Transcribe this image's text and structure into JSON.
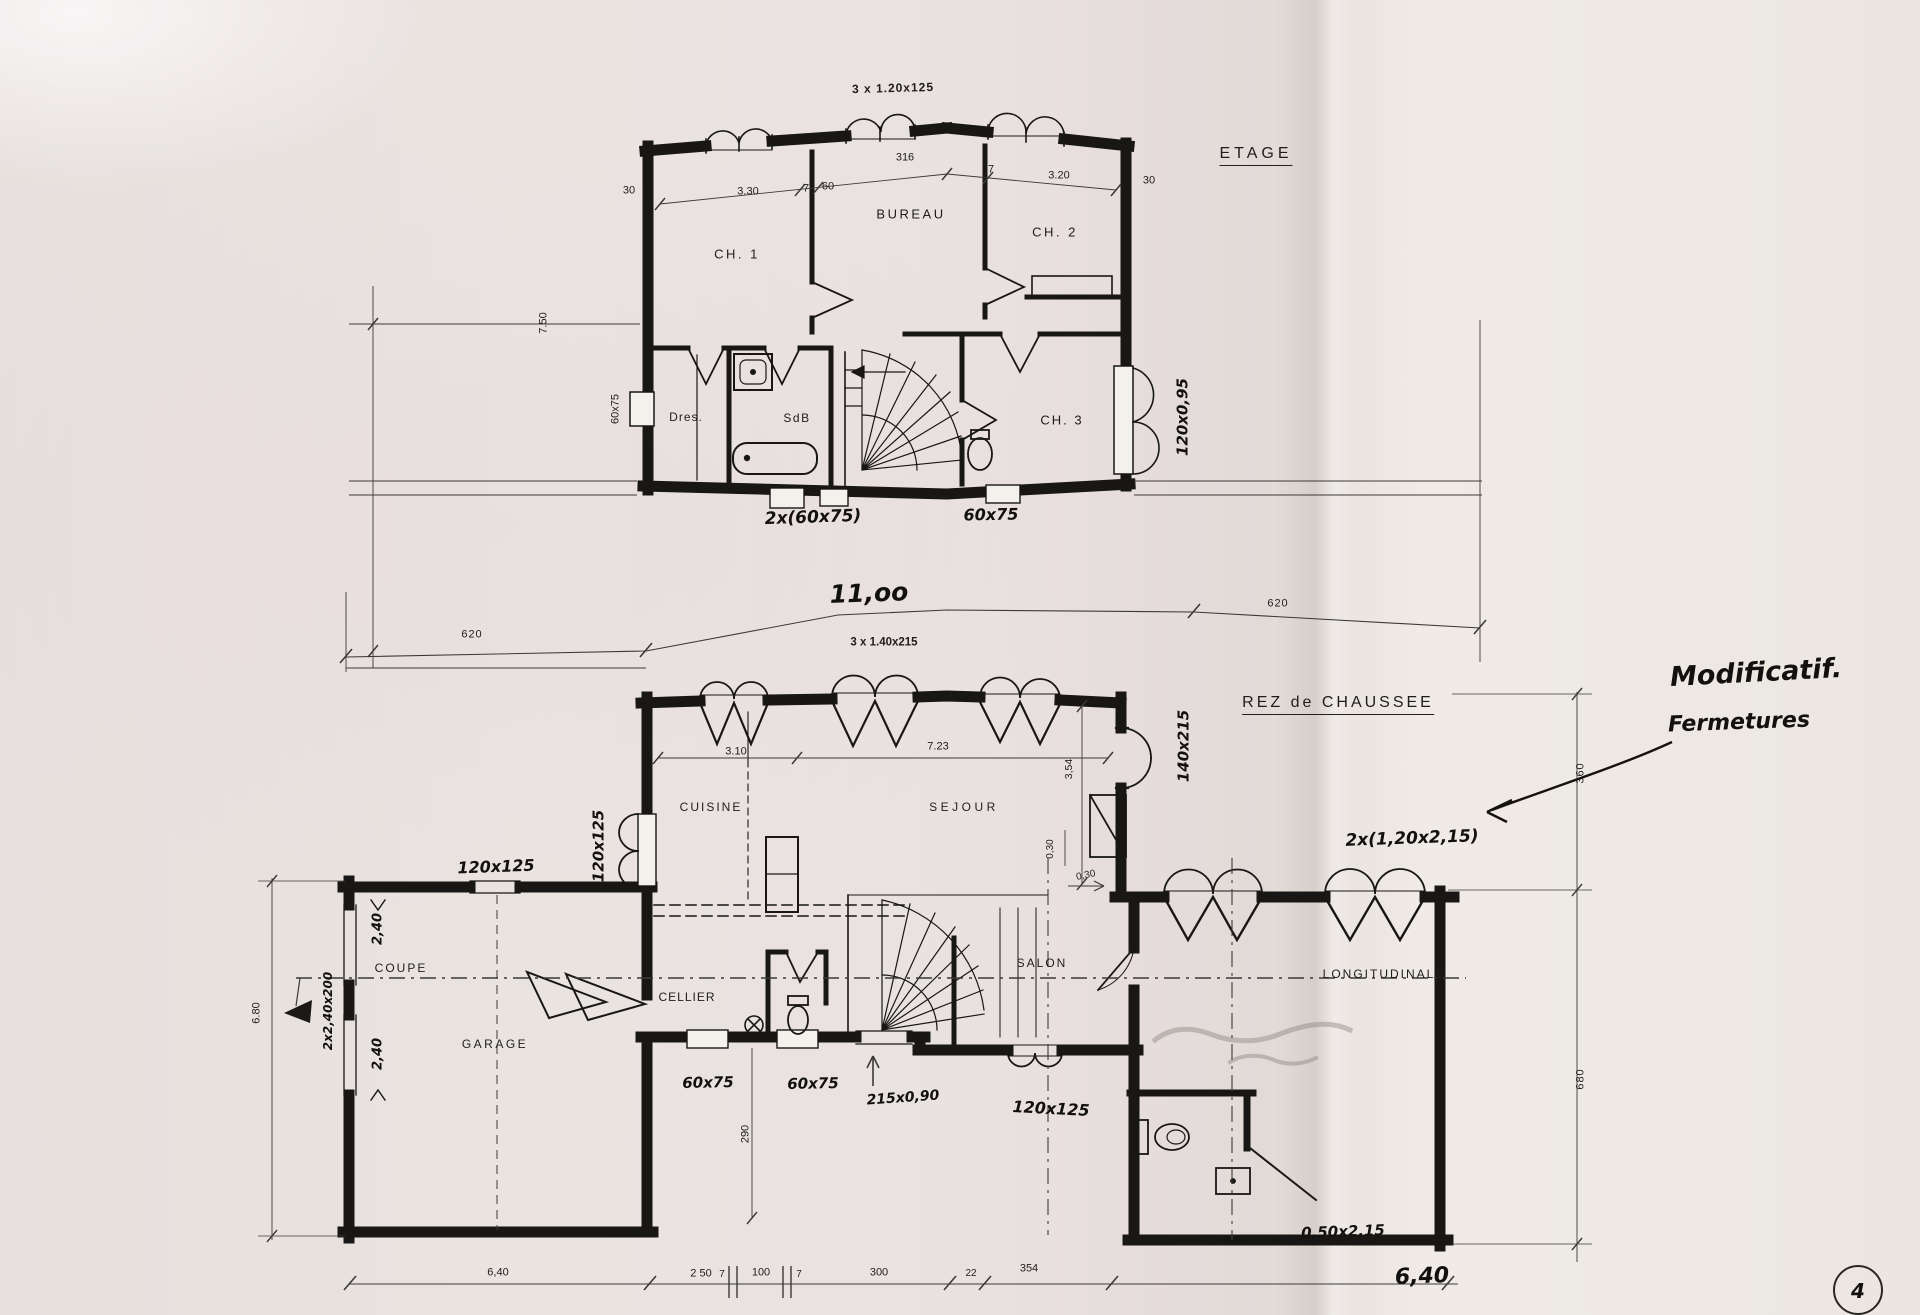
{
  "etage": {
    "title": "ETAGE",
    "window_note": "3 x 1.20x125",
    "rooms": {
      "ch1": "CH. 1",
      "bureau": "BUREAU",
      "ch2": "CH. 2",
      "dres": "Dres.",
      "sdb": "SdB",
      "ch3": "CH. 3"
    },
    "dims_top": [
      "30",
      "3.30",
      "7",
      "60",
      "316",
      "7",
      "3.20",
      "30"
    ],
    "dim_height": "7.50",
    "window_left": "60x75",
    "window_right": "120x0,95",
    "label_below_left": "2x(60x75)",
    "label_below_right": "60x75",
    "width_left": "620",
    "width_total": "11,oo",
    "width_right": "620",
    "window_note_below": "3 x 1.40x215"
  },
  "rez": {
    "title": "REZ de CHAUSSEE",
    "rooms": {
      "cuisine": "CUISINE",
      "sejour": "SEJOUR",
      "garage": "GARAGE",
      "cellier": "CELLIER",
      "salon": "SALON"
    },
    "section": {
      "coupe": "COUPE",
      "longitudinale": "LONGITUDINALE"
    },
    "dims": {
      "cuisine_width": "3.10",
      "sejour_width": "7.23",
      "right_height": "3,54",
      "entry_door": "140x215",
      "offset_a": "0,30",
      "offset_b": "0,30",
      "garage_window": "120x125",
      "cuisine_window": "120x125",
      "salon_window": "120x125",
      "garage_upper": "2,40",
      "garage_lower": "2,40",
      "garage_windows": "2x2,40x200",
      "garage_height": "6.80",
      "hall_depth": "290",
      "cellier_window": "60x75",
      "wc_window": "60x75",
      "back_door": "215x0,90",
      "wc_door": "0,50x2,15",
      "right_width_hand": "6,40",
      "right_upper": "360",
      "right_lower": "680",
      "note_doors": "2x(1,20x2,15)"
    },
    "dims_bottom": [
      "6,40",
      "2 50",
      "7",
      "100",
      "7",
      "300",
      "22",
      "354"
    ]
  },
  "annotations": {
    "note_line1": "Modificatif.",
    "note_line2": "Fermetures",
    "page_number": "4"
  }
}
